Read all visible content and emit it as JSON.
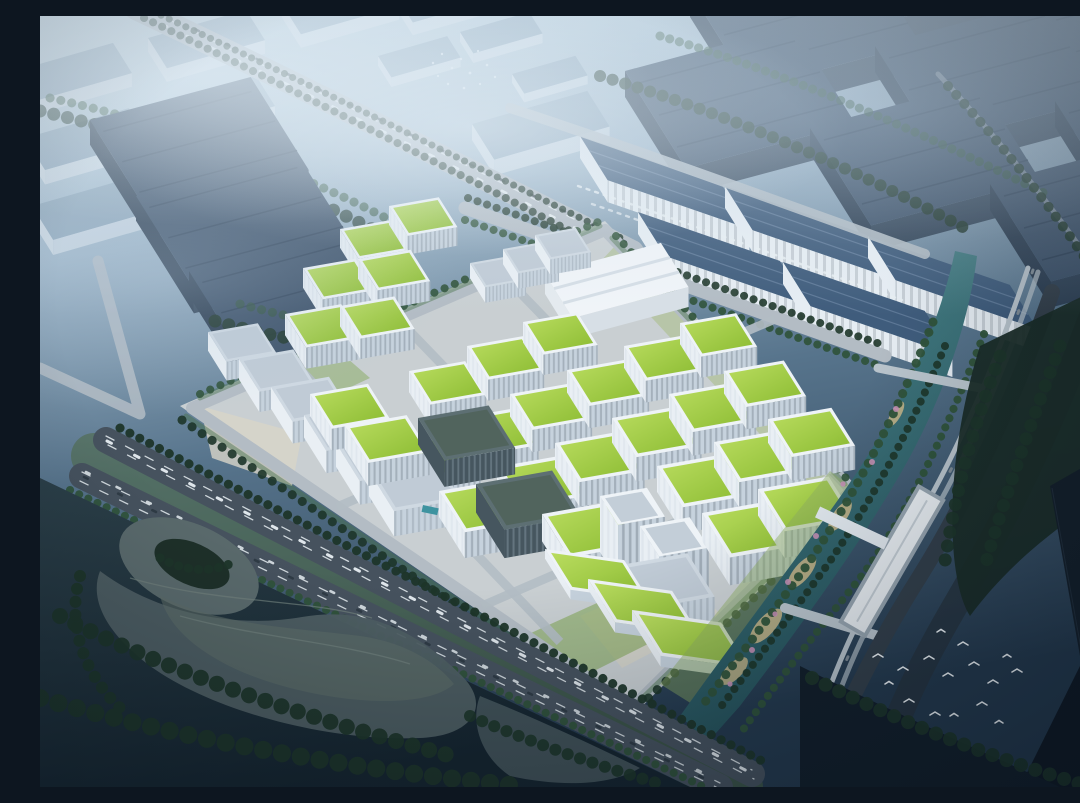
{
  "scene": {
    "description": "Aerial architectural rendering of a riverside industrial business park: rows of white mid-rise factory buildings with bright green planted roofs, a white exhibition hall, logistics sheds and dark big-box warehouses behind, an elevated expressway and a multi-lane highway, a landscaped canal with an elevated metro line and station, dark sculpted parkland with a ring landform, distant city blocks fading into blue haze, and two flocks of white birds.",
    "regions": [
      "far-city-district",
      "elevated-expressway",
      "northwest-warehouses",
      "northeast-logistics-sheds",
      "exhibition-hall",
      "green-roof-campus",
      "campus-towers",
      "canal",
      "metro-viaduct",
      "metro-station",
      "riverside-park",
      "southwest-highway",
      "landform-park",
      "east-fields",
      "bird-flocks"
    ],
    "counts": {
      "green_roof_buildings": 29,
      "green_roof_terraces": 3,
      "logistics_sheds": 5,
      "west_white_buildings": 9,
      "glass_buildings": 2,
      "towers": 2,
      "bird_flocks": 2
    }
  },
  "palette": {
    "sky_top": "#c6d9e4",
    "sky_mid": "#9db5c8",
    "sky_low": "#57748c",
    "sky_bottom": "#24394d",
    "mist": "#dfecf4",
    "far_roof": "#8ea7bb",
    "far_side": "#d3dee7",
    "box_roof": "#3b5068",
    "box_side": "#2b3d51",
    "shed_roof": "#3f5c7c",
    "shed_side": "#e6edf3",
    "tree_dark": "#1d3529",
    "tree_mid": "#2f5239",
    "tree_bright": "#47714a",
    "campus_ground": "#c9cfd2",
    "road": "#b3bcc4",
    "plaza": "#d8d5c8",
    "parapet": "#eef3f7",
    "facade_light": "#e9eff4",
    "facade_shade": "#c6d2dd",
    "window": "#b9c7d3",
    "roof_grey": "#cfd9e2",
    "glass_dark": "#46565f",
    "glass_roof": "#5d6f73",
    "roof_green_hi": "#b9dc5f",
    "roof_green_dk": "#8cbc33",
    "water_hi": "#4d8a90",
    "water_dk": "#245059",
    "sand": "#c9b688",
    "blossom": "#c38fb3",
    "asphalt": "#46525e",
    "asphalt_dark": "#333f4a",
    "lane": "#e8eef2",
    "median": "#4e6a44",
    "park_base": "#22363f",
    "mound": "#55666a",
    "park_green": "#2f5038",
    "field": "#141f2a",
    "field_dark": "#0f1823",
    "viaduct": "#b9c4cc",
    "station": "#e8edf1",
    "platform": "#97a5b0",
    "bird": "#f2f7fa"
  }
}
